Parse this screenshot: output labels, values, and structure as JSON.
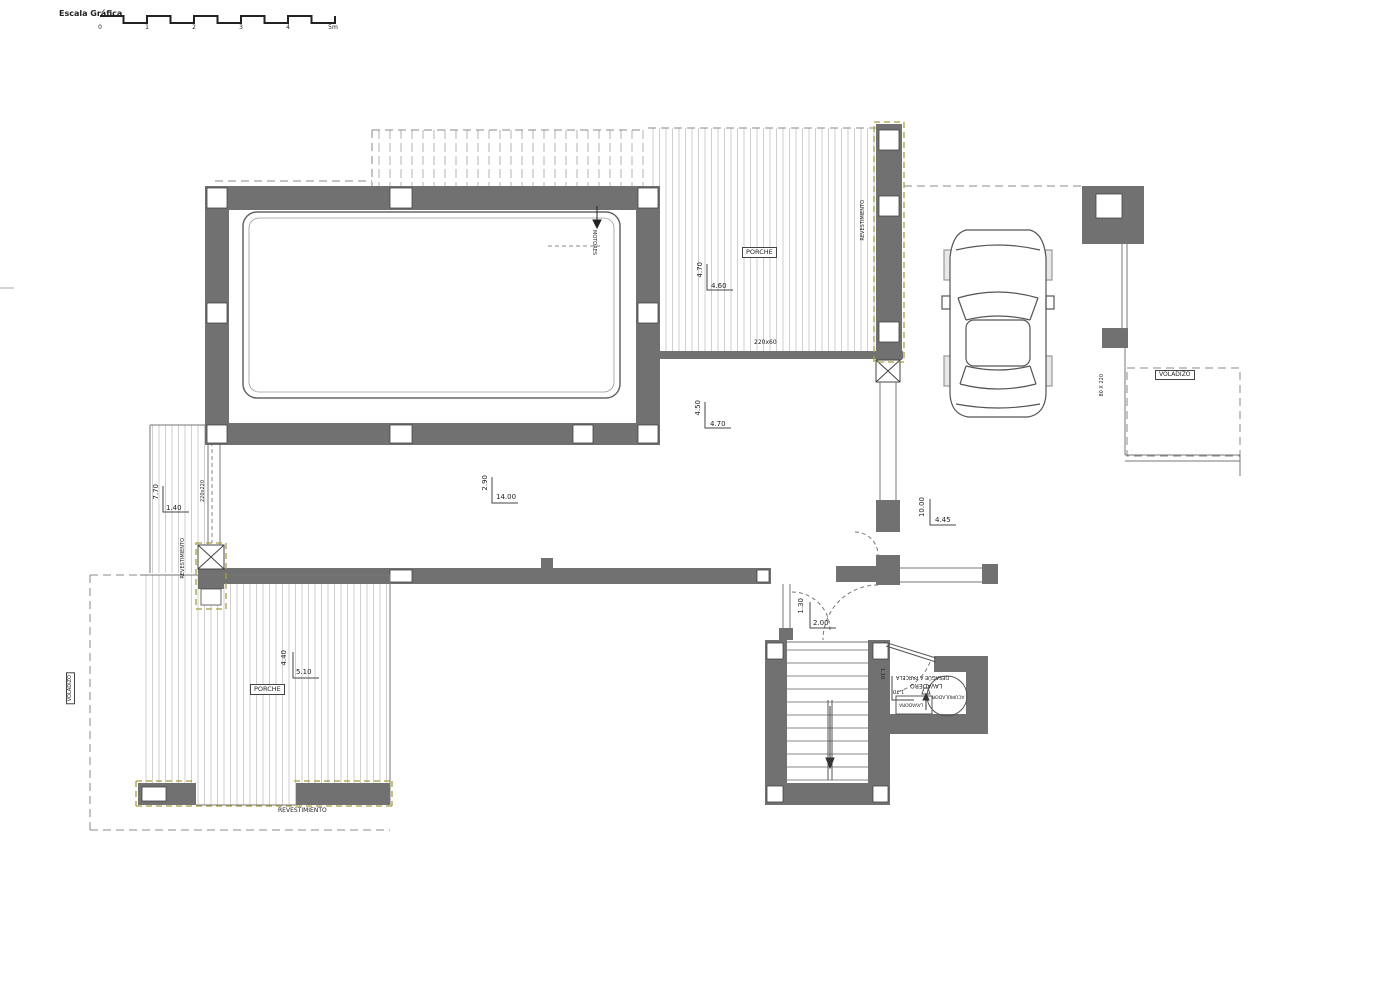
{
  "scale": {
    "label": "Escala Gráfica",
    "t0": "0",
    "t1": "1",
    "t2": "2",
    "t3": "3",
    "t4": "4",
    "t5": "5m"
  },
  "pool": {
    "motors": "MOTORES"
  },
  "porch_top": {
    "label": "PORCHE",
    "dim_v": "4.70",
    "dim_h": "4.60",
    "beam": "220x60",
    "cladding": "REVESTIMIENTO"
  },
  "living": {
    "dim1_v": "4.50",
    "dim1_h": "4.70",
    "dim2_v": "2.90",
    "dim2_h": "14.00"
  },
  "left_side": {
    "dim_v": "7.70",
    "dim_h": "1.40",
    "pillar": "220x220",
    "cladding": "REVESTIMIENTO"
  },
  "porch_left": {
    "label": "PORCHE",
    "dim_v": "4.40",
    "dim_h": "5.10",
    "overhang": "VOLADIZO",
    "cladding": "REVESTIMIENTO"
  },
  "garage": {
    "dim_v": "10.00",
    "dim_h": "4.45",
    "opening": "80 X 220",
    "overhang": "VOLADIZO"
  },
  "entry": {
    "dim_v": "1.30",
    "dim_h": "2.00"
  },
  "laundry": {
    "room": "LAVADERO",
    "drain": "DESAGÜE A PARCELA",
    "dim_v": "1.10",
    "dim_h": "1.70",
    "washer": "LAVADORA",
    "boiler": "ACUMULADOR"
  },
  "colors": {
    "wall": "#717171",
    "accent_dash": "#a89d3f",
    "line": "#4a4a4a",
    "hatch": "#cfcfcf"
  }
}
